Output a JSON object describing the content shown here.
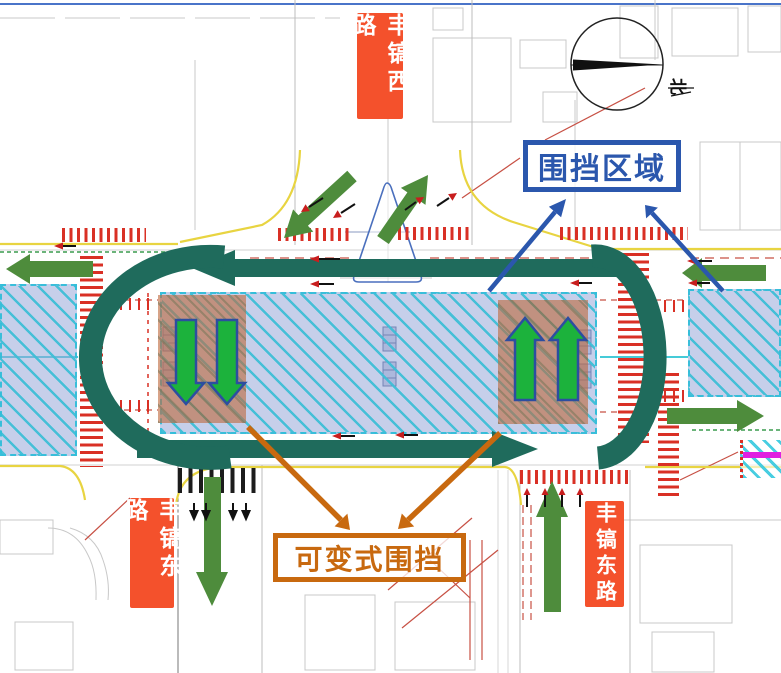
{
  "diagram": {
    "type": "traffic-diversion-enclosure-plan",
    "road_labels": {
      "north_approach": "丰镐西路",
      "south_west": "丰镐东路",
      "south_east": "丰镐东路"
    },
    "callouts": {
      "enclosure_area": {
        "text": "围挡区域",
        "color": "#2B57AD"
      },
      "variable_enclosure": {
        "text": "可变式围挡",
        "color": "#C8690F"
      }
    },
    "compass": {
      "north": "北"
    },
    "flow_arrows": [
      {
        "id": "westbound-through-top",
        "color": "dark-teal",
        "direction": "left"
      },
      {
        "id": "eastbound-through-bottom",
        "color": "dark-teal",
        "direction": "right"
      },
      {
        "id": "left-uturn-connector",
        "color": "dark-teal",
        "shape": "curve"
      },
      {
        "id": "right-uturn-connector",
        "color": "dark-teal",
        "shape": "curve"
      },
      {
        "id": "west-exit",
        "color": "green",
        "direction": "left"
      },
      {
        "id": "north-entry",
        "color": "green",
        "direction": "down-left"
      },
      {
        "id": "north-exit",
        "color": "green",
        "direction": "up-right"
      },
      {
        "id": "east-entry",
        "color": "green",
        "direction": "left"
      },
      {
        "id": "east-exit",
        "color": "green",
        "direction": "right"
      },
      {
        "id": "south-west-exit",
        "color": "green",
        "direction": "down"
      },
      {
        "id": "south-east-entry",
        "color": "green",
        "direction": "up"
      },
      {
        "id": "work-zone-left-lane-arrows",
        "color": "bright-green",
        "direction": "down",
        "count": 2
      },
      {
        "id": "work-zone-right-lane-arrows",
        "color": "bright-green",
        "direction": "up",
        "count": 2
      }
    ],
    "colors": {
      "road_label_bg": "#F4512C",
      "enclosure_blue": "#2B57AD",
      "variable_orange": "#C8690F",
      "flow_teal": "#1F6B5C",
      "flow_green": "#4E8C3C",
      "lane_arrow_green": "#1CB23C",
      "lane_arrow_outline": "#2C4EA0",
      "closure_zone_fill": "#97A7D8",
      "closure_zone_hatch": "#3EBED6",
      "work_zone_fill": "#BE6B3F",
      "crosswalk_red": "#D93025",
      "magenta_lane": "#E020E0",
      "yellow_edge": "#E8D441"
    }
  }
}
